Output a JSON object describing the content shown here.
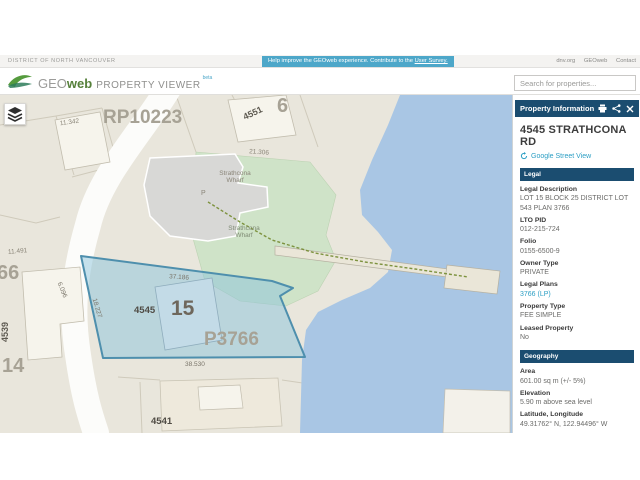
{
  "top_bar": {
    "district": "DISTRICT OF NORTH VANCOUVER",
    "survey_text": "Help improve the GEOweb experience. Contribute to the ",
    "survey_link": "User Survey.",
    "links": [
      "dnv.org",
      "GEOweb",
      "Contact"
    ]
  },
  "header": {
    "logo_geo": "GEO",
    "logo_web": "web",
    "logo_suffix": "PROPERTY VIEWER",
    "logo_beta": "beta",
    "search_placeholder": "Search for properties..."
  },
  "colors": {
    "navy_panel": "#1b4d70",
    "link_teal": "#2d9fc4",
    "banner_blue": "#4da7c9",
    "water": "#a9c6e4",
    "parcel_highlight_border": "#4e8fad",
    "park_green": "#cfe3c8"
  },
  "map": {
    "labels": [
      {
        "name": "label-plan-rp10223",
        "text": "RP10223",
        "x": 103,
        "y": 13,
        "size": 19,
        "color": "#a7a295",
        "bold": true
      },
      {
        "name": "label-dim-11342",
        "text": "11.342",
        "x": 60,
        "y": 25,
        "size": 6.5,
        "color": "#8a8578",
        "rotate": -8
      },
      {
        "name": "label-addr-4551",
        "text": "4551",
        "x": 243,
        "y": 14,
        "size": 9,
        "color": "#5d5950",
        "bold": true,
        "rotate": -25
      },
      {
        "name": "label-lot-6",
        "text": "6",
        "x": 277,
        "y": 1,
        "size": 20,
        "color": "#a7a295",
        "bold": true
      },
      {
        "name": "label-dim-21306",
        "text": "21.306",
        "x": 249,
        "y": 55,
        "size": 6.5,
        "color": "#8a8578",
        "rotate": 4
      },
      {
        "name": "label-strathcona-wharf-1",
        "lines": [
          "Strathcona",
          "Wharf"
        ],
        "x": 213,
        "y": 76,
        "size": 6.5,
        "color": "#8a8578",
        "center": true,
        "w": 44
      },
      {
        "name": "label-parking-p",
        "text": "P",
        "x": 201,
        "y": 95,
        "size": 7,
        "color": "#8a8578"
      },
      {
        "name": "label-strathcona-wharf-2",
        "lines": [
          "Strathcona",
          "Wharf"
        ],
        "x": 222,
        "y": 131,
        "size": 6.5,
        "color": "#7f8a74",
        "center": true,
        "w": 44
      },
      {
        "name": "label-dim-37186",
        "text": "37.186",
        "x": 169,
        "y": 180,
        "size": 6.5,
        "color": "#7a756a",
        "rotate": 4
      },
      {
        "name": "label-dim-18227",
        "text": "18.227",
        "x": 86,
        "y": 210,
        "size": 6.5,
        "color": "#7a756a",
        "rotate": 73
      },
      {
        "name": "label-dim-6096",
        "text": "6.096",
        "x": 53,
        "y": 192,
        "size": 6.5,
        "color": "#7a756a",
        "rotate": 68
      },
      {
        "name": "label-addr-4545",
        "text": "4545",
        "x": 134,
        "y": 211,
        "size": 9.5,
        "color": "#4f4b44",
        "bold": true
      },
      {
        "name": "label-lot-15",
        "text": "15",
        "x": 171,
        "y": 203,
        "size": 21,
        "color": "#6e675c",
        "bold": true
      },
      {
        "name": "label-plan-p3766",
        "text": "P3766",
        "x": 204,
        "y": 235,
        "size": 19,
        "color": "#a7a295",
        "bold": true
      },
      {
        "name": "label-dim-38530",
        "text": "38.530",
        "x": 185,
        "y": 267,
        "size": 6.5,
        "color": "#7a756a"
      },
      {
        "name": "label-dim-11491",
        "text": "11.491",
        "x": 8,
        "y": 154,
        "size": 6.5,
        "color": "#8a8578",
        "rotate": -5
      },
      {
        "name": "label-lot-66",
        "text": "66",
        "x": -3,
        "y": 168,
        "size": 20,
        "color": "#a7a295",
        "bold": true
      },
      {
        "name": "label-addr-4539",
        "text": "4539",
        "x": 1,
        "y": 247,
        "size": 9,
        "color": "#5d5950",
        "bold": true,
        "rotate": -90,
        "origin": "0 0"
      },
      {
        "name": "label-lot-14",
        "text": "14",
        "x": 2,
        "y": 261,
        "size": 20,
        "color": "#a7a295",
        "bold": true
      },
      {
        "name": "label-addr-4541",
        "text": "4541",
        "x": 151,
        "y": 322,
        "size": 9.5,
        "color": "#4f4b44",
        "bold": true
      }
    ]
  },
  "sidebar": {
    "title": "Property Information",
    "address": "4545 STRATHCONA RD",
    "street_view": "Google Street View",
    "sections": [
      {
        "title": "Legal",
        "fields": [
          {
            "label": "Legal Description",
            "value": "LOT 15 BLOCK 25 DISTRICT LOT 543 PLAN 3766"
          },
          {
            "label": "LTO PID",
            "value": "012-215-724"
          },
          {
            "label": "Folio",
            "value": "0155-6500-9"
          },
          {
            "label": "Owner Type",
            "value": "PRIVATE"
          },
          {
            "label": "Legal Plans",
            "value": "3766 (LP)",
            "link": true
          },
          {
            "label": "Property Type",
            "value": "FEE SIMPLE"
          },
          {
            "label": "Leased Property",
            "value": "No"
          }
        ]
      },
      {
        "title": "Geography",
        "fields": [
          {
            "label": "Area",
            "value": "601.00 sq m (+/- 5%)"
          },
          {
            "label": "Elevation",
            "value": "5.90 m above sea level"
          },
          {
            "label": "Latitude, Longitude",
            "value": "49.31762° N, 122.94496° W"
          }
        ]
      },
      {
        "title": "Services",
        "fields": [
          {
            "label": "Sanitary Connection",
            "value": ""
          }
        ]
      }
    ]
  }
}
